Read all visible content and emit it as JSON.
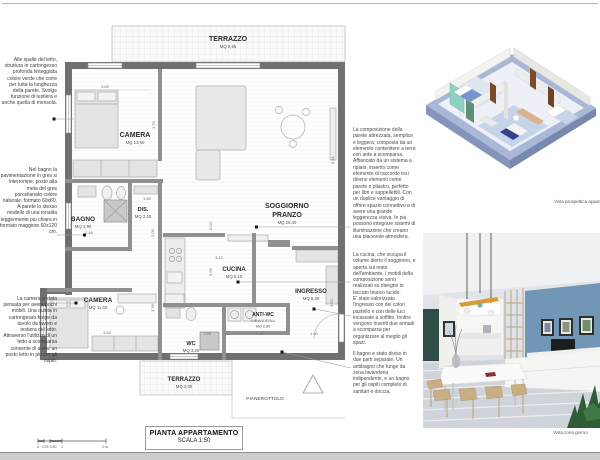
{
  "page": {
    "title_block": {
      "title": "PIANTA APPARTAMENTO",
      "scale": "SCALA 1:50"
    },
    "captions": {
      "perspective": "Vista prospettica appartamento",
      "interior": "Vista zona giorno"
    }
  },
  "annotations": {
    "headboard": "Alle spalle del letto, struttura in cartongesso profonda tinteggiata colore verde che corre per tutta la lunghezza della parete. Svolge funzione di testiera e anche quella di mensola.",
    "bagno": "Nel bagno la pavimentazione in gres si interrompe; posto alla meta del gres porcellanato colore naturale, formato 60x60. A parete lo stesso modello di una tonalita leggermente piu chiara in formato maggiore 60x120 cm.",
    "camera": "La camera e stata pensata per avere pochi mobili. Una quinta in cartongesso funge da tavolo da lavoro e testiera del letto. Attraverso l'utilizzo di un letto a scomparsa consente di avere un posto letto in piu per gli ospiti."
  },
  "paragraphs": {
    "parete": "La composizione della parete attrezzata, semplice e leggera; composta da un elemento contenitore a terra con ante a scomparsa. Affiancato da un sistema a ripiani, inserito come elemento di raccordo tra i diversi elementi come parete e pilastro, perfetto per libri e suppellettili. Con un duplice vantaggio di offrire spazio connettivo e di avere una grande leggerezza visiva. In piu possono integrare sistemi di illuminazione che creano una piacevole atmosfera.",
    "cucina": "La cucina, che occupa il volume dietro il soggiorno, e aperta sul resto dell'ambiente. I mobili della composizione sono realizzati su disegno in laccato bianco lucido.",
    "ingresso": "E' stato valorizzato l'ingresso con dei colori pastello e con delle luci incassate a soffitto. Inoltre vengono inseriti due armadi a scomparsa per organizzare al meglio gli spazi.",
    "bagno": "Il bagno e stato diviso in due parti separate. Un antibagno che funge da zona lavanderia indipendente, e un bagno per gli ospiti completo di sanitari e doccia."
  },
  "plan": {
    "rooms": {
      "terrazzo_top": {
        "name": "TERRAZZO",
        "area": "MQ 8,95"
      },
      "camera1": {
        "name": "CAMERA",
        "area": "MQ 13,50"
      },
      "soggiorno": {
        "name1": "SOGGIORNO",
        "name2": "PRANZO",
        "area": "MQ 28,40"
      },
      "bagno": {
        "name": "BAGNO",
        "area": "MQ 4,90"
      },
      "dis": {
        "name": "DIS.",
        "area": "MQ 2,20"
      },
      "cucina": {
        "name": "CUCINA",
        "area": "MQ 6,10"
      },
      "camera2": {
        "name": "CAMERA",
        "area": "MQ 11,50"
      },
      "ingresso": {
        "name": "INGRESSO",
        "area": "MQ 5,30"
      },
      "antiwc": {
        "name": "ANTI-WC",
        "sub": "LAVANDERIA",
        "area": "MQ 2,50"
      },
      "wc": {
        "name": "WC",
        "area": "MQ 3,20"
      },
      "terrazzo_bottom": {
        "name": "TERRAZZO",
        "area": "MQ 2,05"
      },
      "pianerottolo": {
        "name": "PIANEROTTOLO"
      }
    },
    "dims": {
      "camera1_w": "3.65",
      "camera1_h": "3.70",
      "soggiorno_h": "8.41",
      "parete_h": "5.00",
      "cucina_w": "3.12",
      "cucina_h": "5.95",
      "dis_w": "1.50",
      "dis_h": "2.00",
      "bagno_w": "2,45",
      "camera2_w": "3.65",
      "camera2_h": "3.36",
      "wc_w": "1.98",
      "antiwc_w": "1.61",
      "ingresso_w": "1.50",
      "ingresso_h": "3.50"
    },
    "scale_bar": {
      "l0": "0",
      "l1": "0,25",
      "l2": "0,50",
      "l3": "1",
      "l4": "2 m"
    }
  }
}
